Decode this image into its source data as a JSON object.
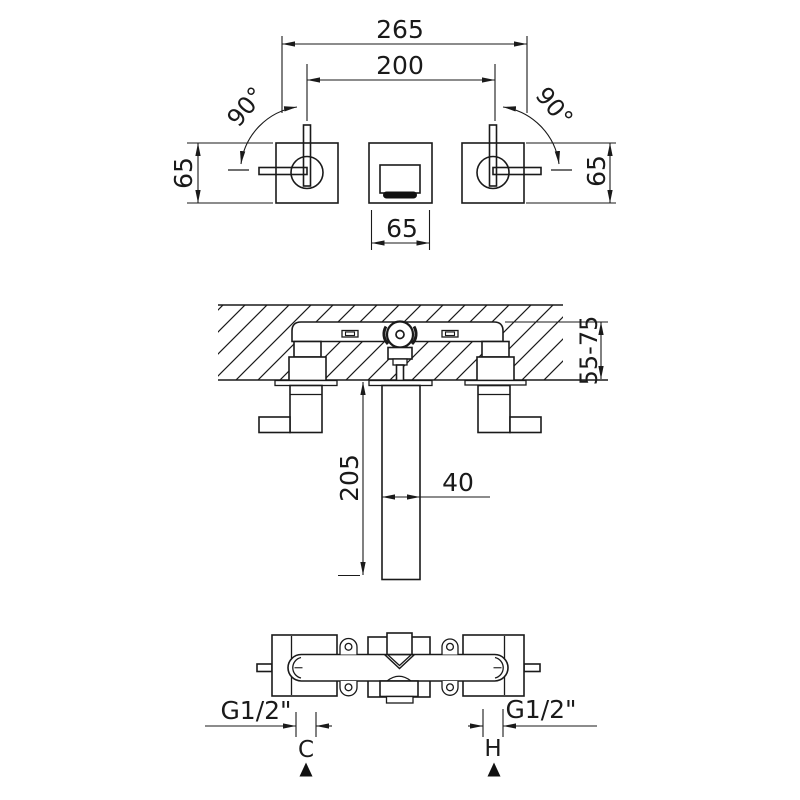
{
  "colors": {
    "line": "#1a1a1a",
    "background": "#ffffff",
    "black_fill": "#111111"
  },
  "front_view": {
    "overall_width": "265",
    "handle_centers": "200",
    "angle_left": "90°",
    "angle_right": "90°",
    "plate_height_left": "65",
    "plate_height_right": "65",
    "spout_plate_width": "65"
  },
  "section_view": {
    "wall_depth_range": "55-75",
    "spout_drop": "205",
    "spout_width": "40"
  },
  "plan_view": {
    "thread_left": "G1/2\"",
    "thread_right": "G1/2\"",
    "cold_indicator": "C",
    "hot_indicator": "H"
  }
}
